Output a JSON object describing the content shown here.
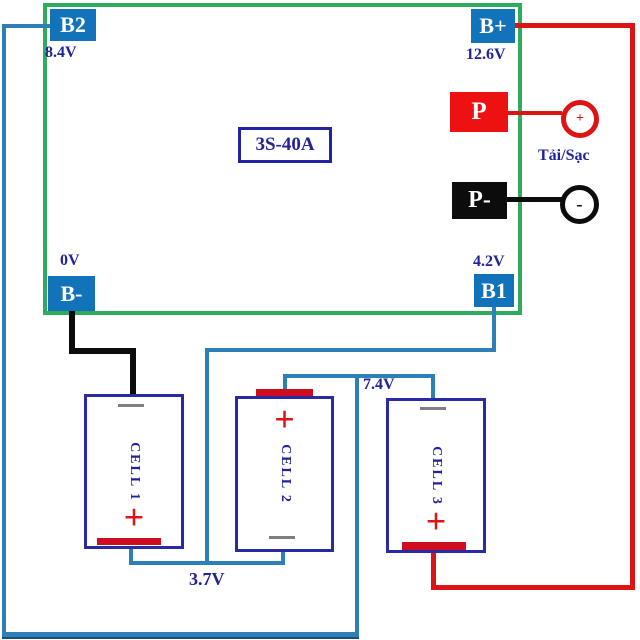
{
  "board": {
    "model_label": "3S-40A"
  },
  "terminals": {
    "b2": {
      "label": "B2",
      "voltage": "8.4V"
    },
    "b_plus": {
      "label": "B+",
      "voltage": "12.6V"
    },
    "b_minus": {
      "label": "B-",
      "voltage": "0V"
    },
    "b1": {
      "label": "B1",
      "voltage": "4.2V"
    },
    "p_plus": {
      "label": "P"
    },
    "p_minus": {
      "label": "P-"
    }
  },
  "load_connector": {
    "label": "Tải/Sạc",
    "positive_mark": "+",
    "negative_mark": "-"
  },
  "cells": [
    {
      "name": "CELL 1",
      "positive_mark": "+"
    },
    {
      "name": "CELL 2",
      "positive_mark": "+"
    },
    {
      "name": "CELL 3",
      "positive_mark": "+"
    }
  ],
  "junctions": {
    "cell1_cell2": "3.7V",
    "cell2_cell3": "7.4V"
  },
  "colors": {
    "board_border_green": "#2eab5c",
    "terminal_blue": "#1273bb",
    "wire_blue": "#2e7fb5",
    "wire_red": "#dd1414",
    "wire_black": "#0c0c0c",
    "label_navy": "#22229b",
    "cell_border_navy": "#2a2aa4",
    "red_bar": "#ce0d20"
  }
}
